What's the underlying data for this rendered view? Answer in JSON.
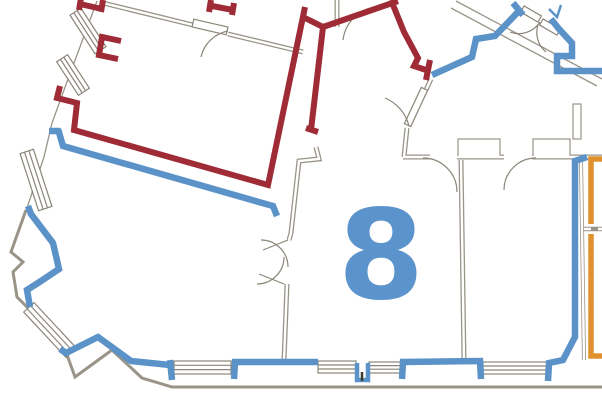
{
  "floor_plan": {
    "unit_label": "8",
    "colors": {
      "background": "#ffffff",
      "base_walls": "#9a9488",
      "thin_lines": "#8a8578",
      "red_unit": "#9e2b35",
      "blue_unit": "#5b93c8",
      "unit_label_color": "#5b93cd",
      "orange_unit": "#e0912f",
      "fixture_dark": "#3f3c30"
    }
  }
}
